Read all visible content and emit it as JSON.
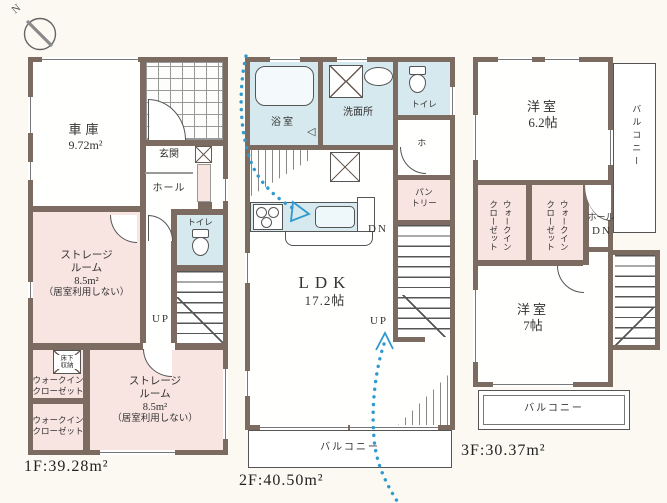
{
  "colors": {
    "wall": "#7b6b60",
    "room_pink": "#f8e4e1",
    "room_blue": "#d6e9ee",
    "path_blue": "#2f9ace",
    "background": "#fbf9f2",
    "outline": "#555555"
  },
  "compass": {
    "north_label": "N"
  },
  "floor1": {
    "garage_name": "車庫",
    "garage_area": "9.72m²",
    "entrance": "玄関",
    "hall": "ホール",
    "toilet": "トイレ",
    "up": "UP",
    "storage": {
      "l1": "ストレージ",
      "l2": "ルーム",
      "l3": "8.5m²",
      "l4": "（居室利用しない）"
    },
    "underfloor": {
      "l1": "床下",
      "l2": "収納"
    },
    "wic": {
      "l1": "ウォークイン",
      "l2": "クローゼット"
    },
    "area_label": "1F:39.28m²"
  },
  "floor2": {
    "bath": "浴室",
    "washroom": "洗面所",
    "toilet": "トイレ",
    "hall": "ホール",
    "pantry": {
      "l1": "パン",
      "l2": "トリー"
    },
    "ldk": {
      "l1": "LDK",
      "l2": "17.2帖"
    },
    "dn": "DN",
    "up": "UP",
    "balcony": "バルコニー",
    "area_label": "2F:40.50m²"
  },
  "floor3": {
    "room_a": {
      "name": "洋室",
      "size": "6.2帖"
    },
    "room_b": {
      "name": "洋室",
      "size": "7帖"
    },
    "wic": {
      "l1": "ウォークイン",
      "l2": "クローゼット"
    },
    "hall": "ホール",
    "dn": "DN",
    "balcony_side": "バルコニー",
    "balcony_bottom": "バルコニー",
    "area_label": "3F:30.37m²"
  }
}
